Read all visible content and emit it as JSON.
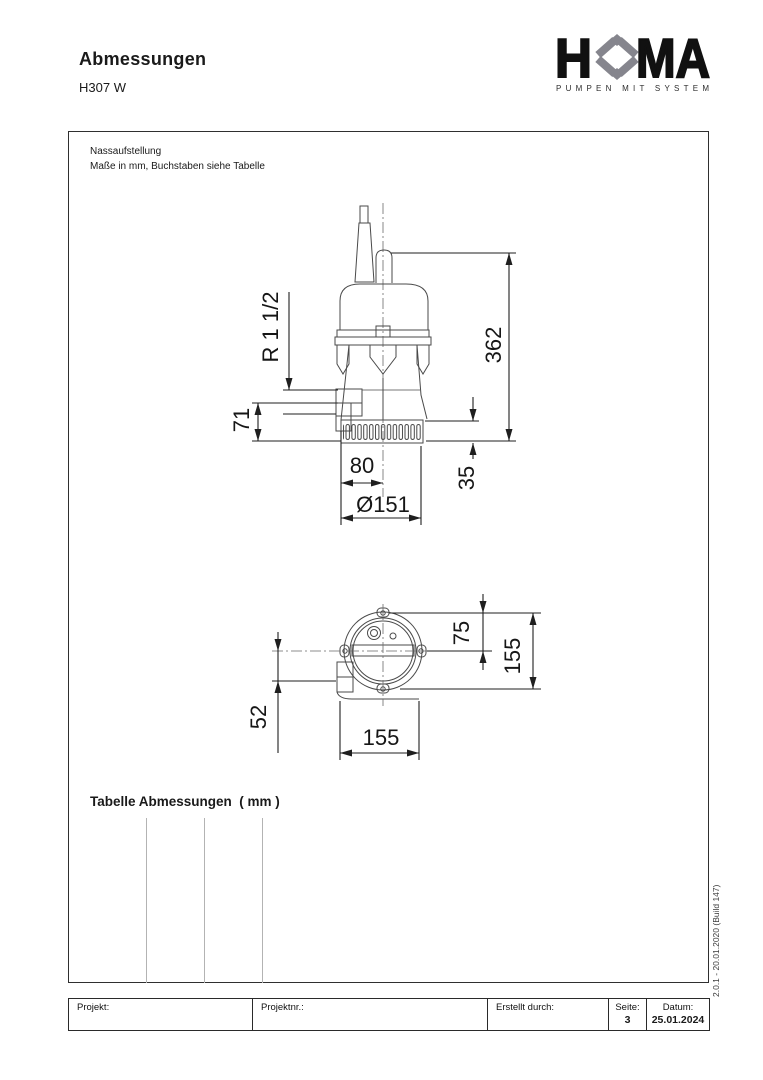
{
  "header": {
    "title": "Abmessungen",
    "model": "H307 W"
  },
  "logo": {
    "word_left": "H",
    "word_right": "MA",
    "tagline": "PUMPEN MIT SYSTEM",
    "text_color": "#111111",
    "diamond_color": "#85858d"
  },
  "drawing": {
    "note_line1": "Nassaufstellung",
    "note_line2": "Maße in mm, Buchstaben siehe Tabelle",
    "dims": {
      "front": {
        "thread": "R 1 1/2",
        "total_height": "362",
        "outlet_height": "71",
        "outlet_offset": "80",
        "strainer_height": "35",
        "diameter": "Ø151"
      },
      "top": {
        "top_to_center": "75",
        "height": "155",
        "center_to_outlet": "52",
        "width": "155"
      }
    }
  },
  "table": {
    "heading": "Tabelle Abmessungen  ( mm )"
  },
  "version_text": "2.0.1 - 20.01.2020 (Build 147)",
  "footer": {
    "project_label": "Projekt:",
    "project_no_label": "Projektnr.:",
    "created_by_label": "Erstellt durch:",
    "page_label": "Seite:",
    "page_value": "3",
    "date_label": "Datum:",
    "date_value": "25.01.2024"
  }
}
